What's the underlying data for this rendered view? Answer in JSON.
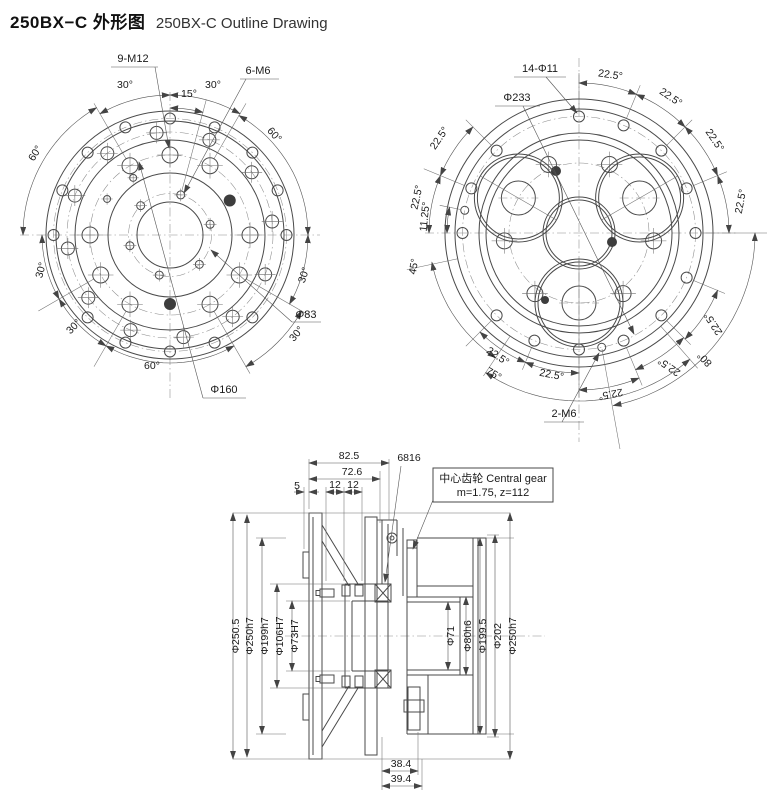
{
  "title": {
    "zh": "250BX−C 外形图",
    "en": "250BX-C Outline Drawing"
  },
  "left_view": {
    "labels": {
      "bolts_m12": "9-M12",
      "bolts_m6": "6-M6",
      "dia_bolt_circle_small": "Φ83",
      "dia_bolt_circle_m12": "Φ160"
    },
    "angles": {
      "top_left_30": "30°",
      "top_15": "15°",
      "top_right_30": "30°",
      "upper_left_60": "60°",
      "right_60": "60°",
      "left_30": "30°",
      "lower_left_30": "30°",
      "bottom_60": "60°",
      "lower_right_30": "30°",
      "right_lower_30": "30°"
    }
  },
  "right_view": {
    "labels": {
      "holes": "14-Φ11",
      "dia_bolt_circle": "Φ233",
      "bolts_m6": "2-M6"
    },
    "angles": {
      "top_0": "22.5°",
      "top_1": "22.5°",
      "top_2": "22.5°",
      "top_3": "22.5°",
      "left_0": "22.5°",
      "left_1": "22.5°",
      "left_11_25": "11.25°",
      "left_45": "45°",
      "bottom_75": "75°",
      "bottom_0": "22.5°",
      "bottom_1": "22.5°",
      "bottom_2": "22.5°",
      "right_0": "22.5°",
      "right_80": "80°",
      "right_1": "22.5°"
    }
  },
  "section_view": {
    "top_dims": {
      "d82_5": "82.5",
      "d72_6": "72.6",
      "d5": "5",
      "d12a": "12",
      "d12b": "12"
    },
    "bearing": "6816",
    "gear_note": {
      "line1": "中心齿轮 Central gear",
      "line2": "m=1.75, z=112"
    },
    "left_dims": [
      "Φ250.5",
      "Φ250h7",
      "Φ199h7",
      "Φ106H7",
      "Φ73H7"
    ],
    "right_dims": [
      "Φ71",
      "Φ80h6",
      "Φ199.5",
      "Φ202",
      "Φ250h7"
    ],
    "bottom_dims": [
      "38.4",
      "39.4"
    ]
  }
}
